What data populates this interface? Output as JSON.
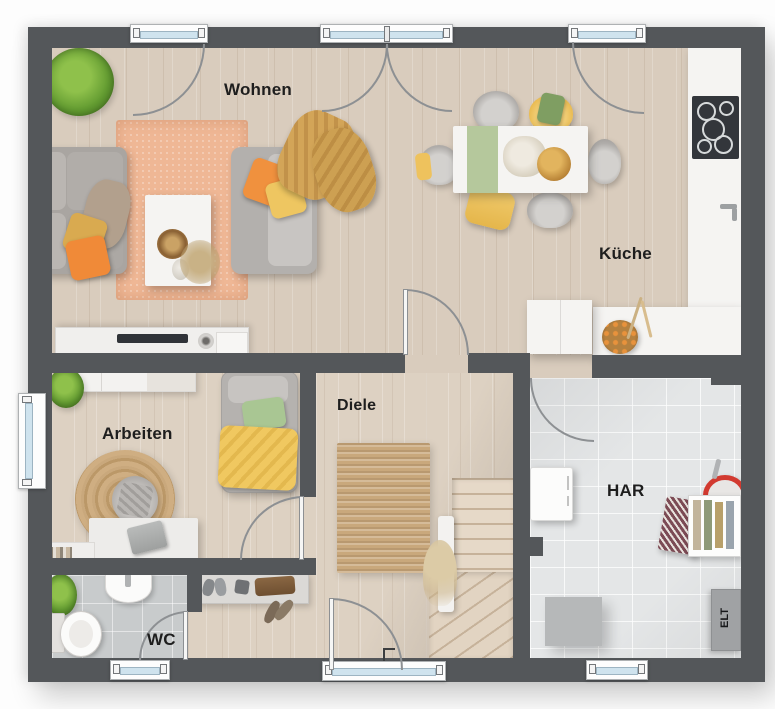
{
  "labels": {
    "wohnen": "Wohnen",
    "kueche": "Küche",
    "arbeiten": "Arbeiten",
    "diele": "Diele",
    "har": "HAR",
    "wc": "WC",
    "elt": "ELT"
  },
  "palette": {
    "wall": "#54575a",
    "wood_floor": "#d9ccbd",
    "tile_wc": "#c8cbcc",
    "tile_har": "#e4e6e7",
    "rug_orange": "#efb795",
    "jute": "#c9a87c",
    "accent_orange": "#f08a38",
    "accent_yellow": "#eec661",
    "accent_green": "#a9c693",
    "counter_white": "#f4f4f3",
    "bucket_red": "#d23a30",
    "window_glass": "#cfe3ee"
  }
}
